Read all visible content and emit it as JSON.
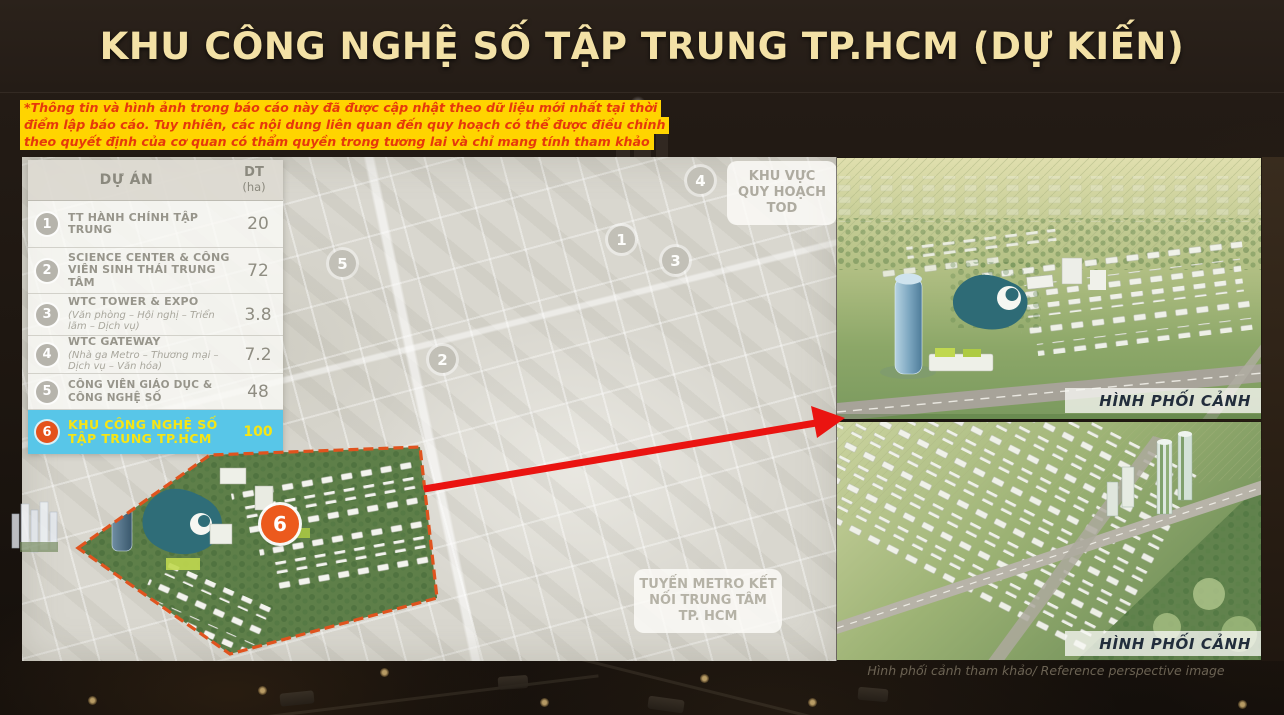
{
  "slide": {
    "title": "KHU CÔNG NGHỆ SỐ TẬP TRUNG TP.HCM (DỰ KIẾN)",
    "disclaimer": {
      "line1": "*Thông tin và hình ảnh trong báo cáo này đã được cập nhật theo dữ liệu mới nhất tại thời",
      "line2": "điểm lập báo cáo. Tuy nhiên, các nội dung liên quan đến quy hoạch có thể được điều chỉnh",
      "line3": "theo quyết định của cơ quan có thẩm quyền trong tương lai và chỉ mang tính tham khảo"
    }
  },
  "table": {
    "header": {
      "project": "DỰ ÁN",
      "area": "DT",
      "area_unit": "(ha)"
    },
    "rows": [
      {
        "num": "1",
        "name": "TT HÀNH CHÍNH TẬP TRUNG",
        "sub": "",
        "area": "20"
      },
      {
        "num": "2",
        "name": "SCIENCE CENTER & CÔNG VIÊN SINH THÁI TRUNG TÂM",
        "sub": "",
        "area": "72"
      },
      {
        "num": "3",
        "name": "WTC TOWER & EXPO",
        "sub": "(Văn phòng – Hội nghị – Triển lãm – Dịch vụ)",
        "area": "3.8"
      },
      {
        "num": "4",
        "name": "WTC GATEWAY",
        "sub": "(Nhà ga Metro – Thương mại – Dịch vụ – Văn hóa)",
        "area": "7.2"
      },
      {
        "num": "5",
        "name": "CÔNG VIÊN GIÁO DỤC & CÔNG NGHỆ SỐ",
        "sub": "",
        "area": "48"
      },
      {
        "num": "6",
        "name": "KHU CÔNG NGHỆ SỐ TẬP TRUNG TP.HCM",
        "sub": "",
        "area": "100"
      }
    ]
  },
  "map": {
    "markers": [
      {
        "label": "1"
      },
      {
        "label": "2"
      },
      {
        "label": "3"
      },
      {
        "label": "4"
      },
      {
        "label": "5"
      }
    ],
    "tod_label": "KHU VỰC QUY HOẠCH TOD",
    "metro_label": "TUYẾN METRO KẾT NỐI TRUNG TÂM TP. HCM",
    "site_badge": "6"
  },
  "renders": {
    "top_label": "HÌNH PHỐI CẢNH",
    "bottom_label": "HÌNH PHỐI CẢNH",
    "caption": "Hình phối cảnh tham khảo/ Reference perspective image"
  },
  "colors": {
    "title_gold": "#f3e1a6",
    "highlight_blue": "#58c6e8",
    "highlight_yellow": "#f6e515",
    "badge_orange": "#e4521c",
    "arrow_red": "#ea1411",
    "disclaimer_bg": "#ffd400",
    "disclaimer_text": "#e6380b"
  }
}
